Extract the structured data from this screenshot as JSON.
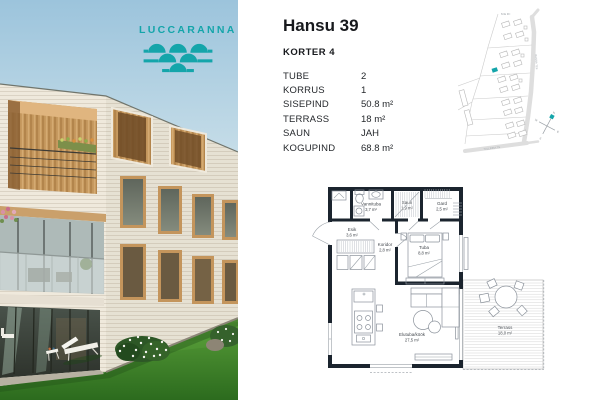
{
  "logo": {
    "name": "LUCCARANNA",
    "accent_color": "#14a5aa"
  },
  "header": {
    "title": "Hansu 39",
    "subtitle": "KORTER 4"
  },
  "specs": {
    "rows": [
      {
        "label": "TUBE",
        "value": "2"
      },
      {
        "label": "KORRUS",
        "value": "1"
      },
      {
        "label": "SISEPIND",
        "value": "50.8 m²"
      },
      {
        "label": "TERRASS",
        "value": "18 m²"
      },
      {
        "label": "SAUN",
        "value": "JAH"
      },
      {
        "label": "KOGUPIND",
        "value": "68.8 m²"
      }
    ]
  },
  "site_map": {
    "sea_label": "MERI",
    "street_vertical": "RANNA TEE",
    "street_bottom": "TALLINNA TN",
    "compass": {
      "north": "N",
      "east": "E",
      "south": "S",
      "west": "W"
    },
    "highlight_color": "#14a5aa"
  },
  "floor_plan": {
    "wall_color": "#1b242e",
    "rooms": [
      {
        "name": "Vannituba",
        "area": "3,7 m²"
      },
      {
        "name": "Saun",
        "area": "1,9 m²"
      },
      {
        "name": "Gard",
        "area": "2,5 m²"
      },
      {
        "name": "Esik",
        "area": "3,6 m²"
      },
      {
        "name": "Koridor",
        "area": "2,8 m²"
      },
      {
        "name": "Tuba",
        "area": "8,8 m²"
      },
      {
        "name": "Elutuba/köök",
        "area": "27,5 m²"
      },
      {
        "name": "Terrass",
        "area": "18,0 m²"
      }
    ]
  }
}
